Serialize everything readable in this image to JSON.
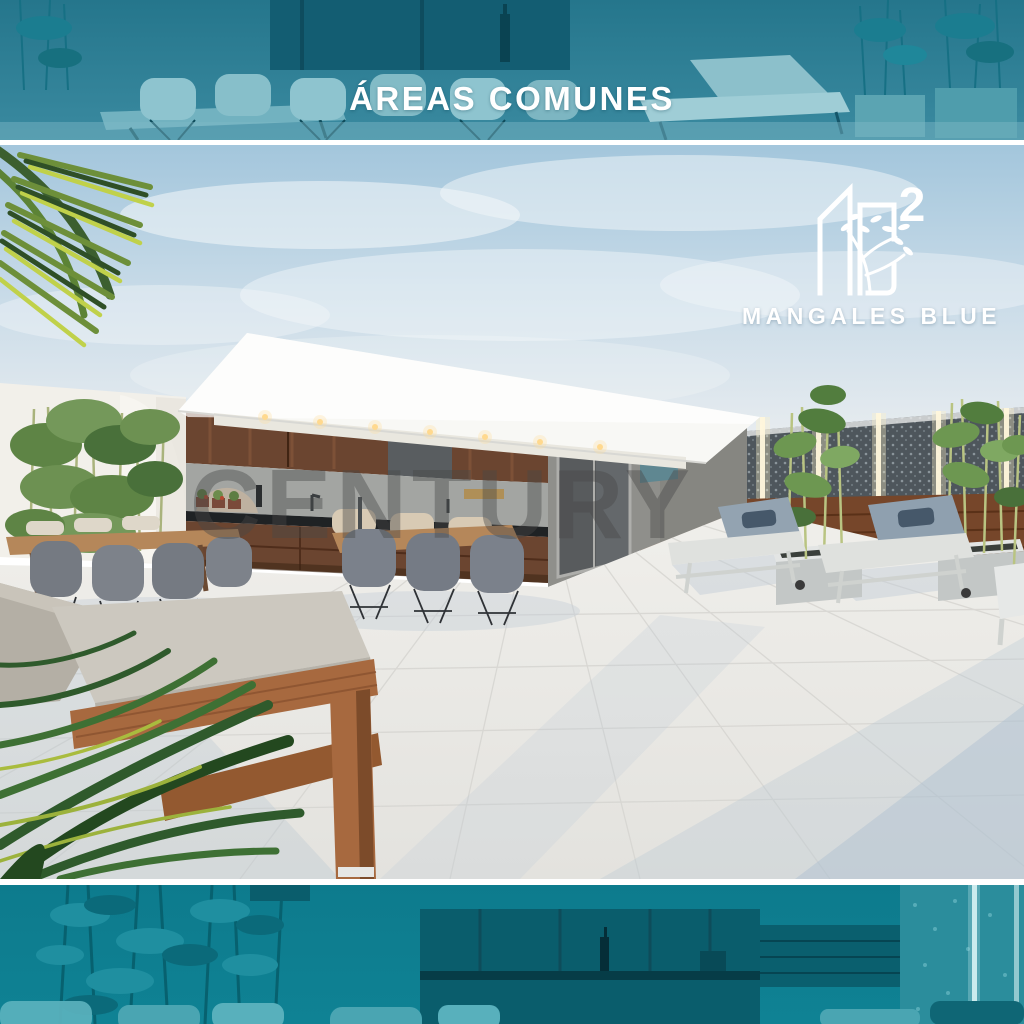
{
  "header": {
    "title": "ÁREAS COMUNES"
  },
  "logo": {
    "brand": "MANGALES BLUE",
    "superscript": "2",
    "icon": "buildings-branch-icon"
  },
  "watermark": {
    "text": "CENTURY"
  },
  "colors": {
    "banner_teal": "#2E7F95",
    "footer_teal": "#0D7B8D",
    "title_white": "#FFFFFF",
    "logo_white": "#FFFFFF",
    "watermark_gray": "rgba(72,72,72,0.42)"
  }
}
